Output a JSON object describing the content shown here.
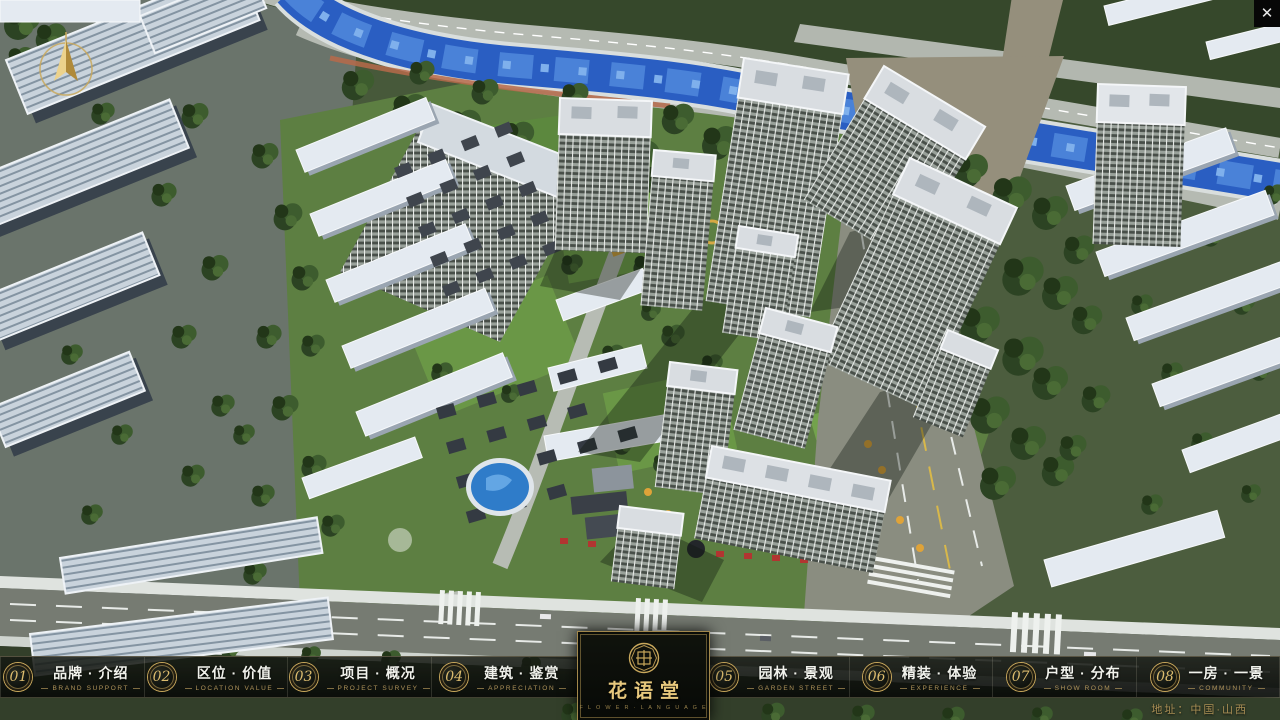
{
  "colors": {
    "gold": "#c9a85c",
    "bar_bg": "#0c100c",
    "river_blue": "#2a5ec2"
  },
  "icons": {
    "close": "✕",
    "compass": "north-arrow",
    "logo_seal": "octagonal-seal"
  },
  "logo": {
    "name": "花语堂",
    "subtitle": "F L O W E R · L A N G U A G E"
  },
  "menu": {
    "items": [
      {
        "num": "01",
        "zh": "品牌 · 介绍",
        "en": "BRAND SUPPORT"
      },
      {
        "num": "02",
        "zh": "区位 · 价值",
        "en": "LOCATION VALUE"
      },
      {
        "num": "03",
        "zh": "项目 · 概况",
        "en": "PROJECT SURVEY"
      },
      {
        "num": "04",
        "zh": "建筑 · 鉴赏",
        "en": "APPRECIATION"
      },
      {
        "num": "05",
        "zh": "园林 · 景观",
        "en": "GARDEN STREET"
      },
      {
        "num": "06",
        "zh": "精装 · 体验",
        "en": "EXPERIENCE"
      },
      {
        "num": "07",
        "zh": "户型 · 分布",
        "en": "SHOW ROOM"
      },
      {
        "num": "08",
        "zh": "一房 · 一景",
        "en": "COMMUNITY"
      }
    ]
  },
  "footer": {
    "address": "地址：中国·山西"
  }
}
